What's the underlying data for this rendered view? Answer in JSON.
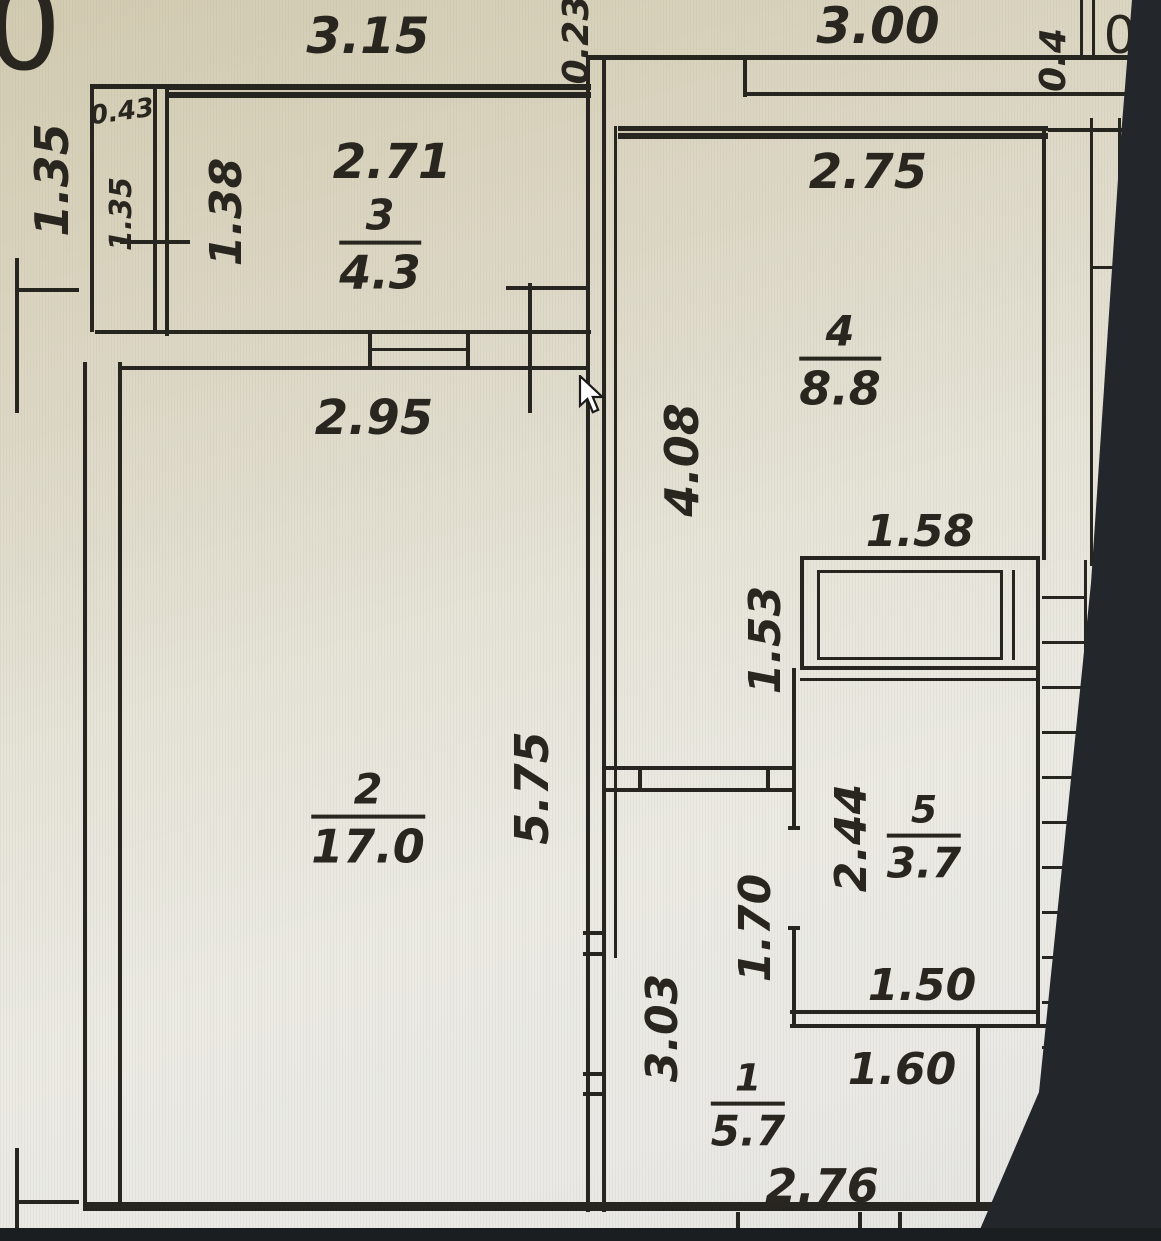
{
  "plan": {
    "outer": {
      "top_left_width": "3.15",
      "wall_gap": "0.23",
      "top_right_width": "3.00",
      "right_stub": "0.4",
      "left_height": "1.35",
      "partial_glyph_left": "0",
      "partial_glyph_right": "0"
    },
    "shaft": {
      "width": "0.43",
      "height": "1.35"
    },
    "rooms": {
      "r1": {
        "number": "1",
        "area": "5.7",
        "height": "3.03",
        "inner_width": "1.60",
        "bottom_width": "2.76"
      },
      "r2": {
        "number": "2",
        "area": "17.0",
        "top_width": "2.95",
        "height": "5.75"
      },
      "r3": {
        "number": "3",
        "area": "4.3",
        "top_width": "2.71",
        "height": "1.38"
      },
      "r4": {
        "number": "4",
        "area": "8.8",
        "top_width": "2.75",
        "height": "4.08"
      },
      "r5": {
        "number": "5",
        "area": "3.7",
        "height": "2.44",
        "bottom_width": "1.50",
        "shaft_width": "1.58",
        "offset_top": "1.53",
        "offset_door": "1.70"
      }
    }
  }
}
